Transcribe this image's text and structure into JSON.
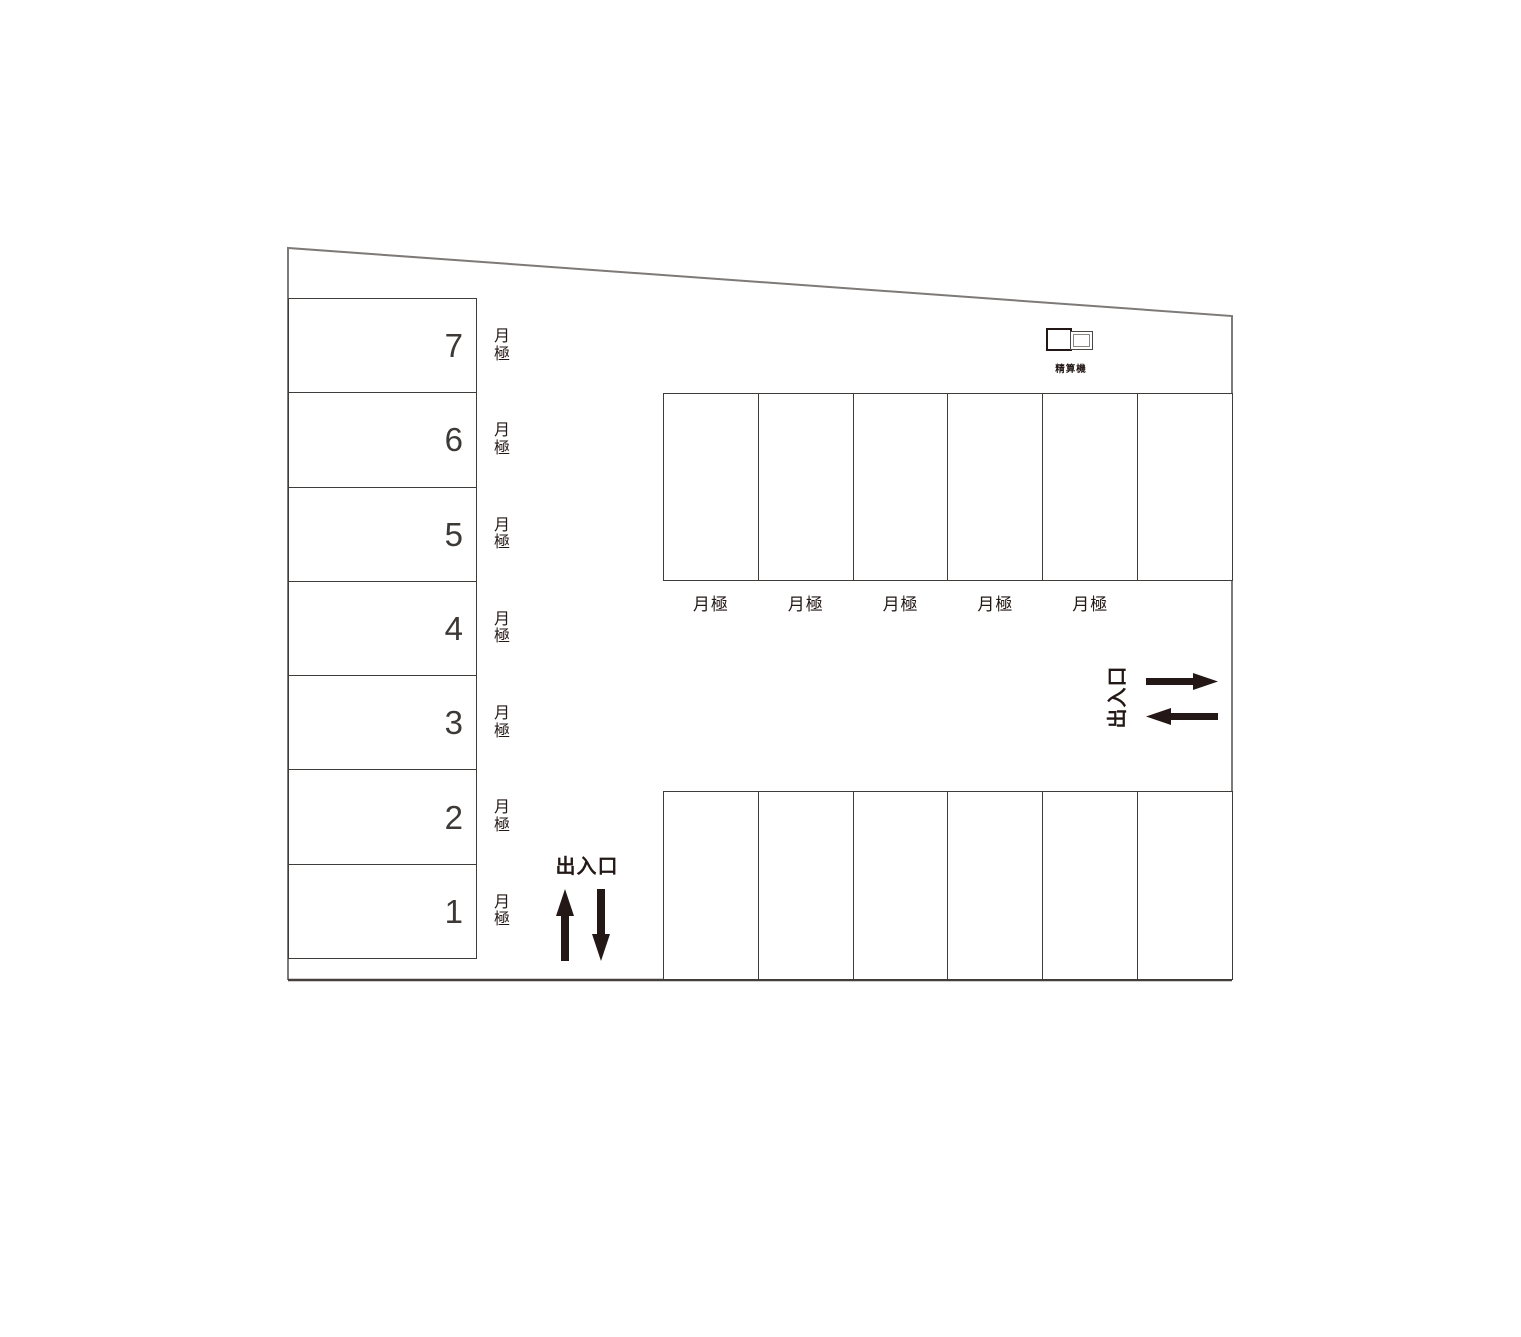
{
  "colors": {
    "ink": "#231815",
    "stall_line": "#403c3a",
    "boundary": "#7d7a78",
    "boundary_bottom": "#45403e"
  },
  "left_column": {
    "stalls": [
      {
        "number": "7",
        "label": "月極"
      },
      {
        "number": "6",
        "label": "月極"
      },
      {
        "number": "5",
        "label": "月極"
      },
      {
        "number": "4",
        "label": "月極"
      },
      {
        "number": "3",
        "label": "月極"
      },
      {
        "number": "2",
        "label": "月極"
      },
      {
        "number": "1",
        "label": "月極"
      }
    ]
  },
  "top_row": {
    "stall_count": 6,
    "labels": [
      "月極",
      "月極",
      "月極",
      "月極",
      "月極"
    ]
  },
  "bottom_row": {
    "stall_count": 6
  },
  "payment_machine": {
    "label": "精算機",
    "icon": "payment-machine-icon"
  },
  "entrance_bottom": {
    "label": "出入口",
    "arrow_icons": [
      "up-arrow-icon",
      "down-arrow-icon"
    ]
  },
  "entrance_right": {
    "label": "出入口",
    "arrow_icons": [
      "right-arrow-icon",
      "left-arrow-icon"
    ]
  }
}
